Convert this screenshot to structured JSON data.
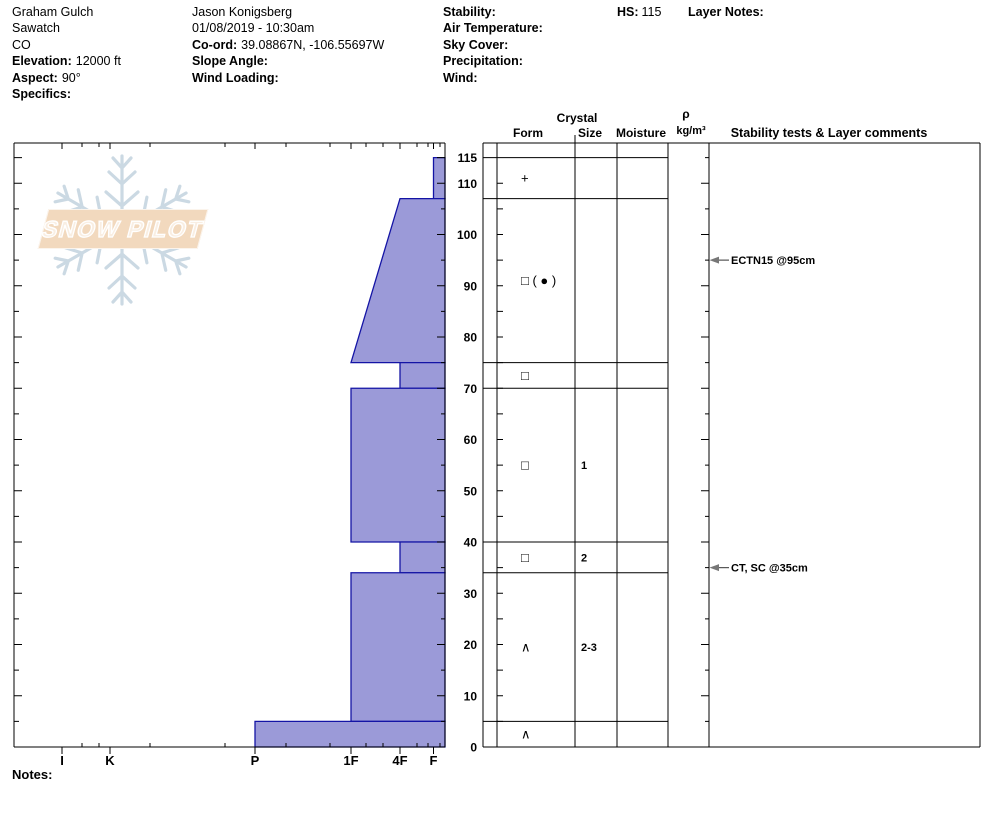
{
  "header": {
    "pit_name": "Graham Gulch",
    "range": "Sawatch",
    "state": "CO",
    "elevation_label": "Elevation:",
    "elevation_value": "12000 ft",
    "aspect_label": "Aspect:",
    "aspect_value": "90°",
    "specifics_label": "Specifics:",
    "observer": "Jason Konigsberg",
    "datetime": "01/08/2019 - 10:30am",
    "coord_label": "Co-ord:",
    "coord_value": "39.08867N, -106.55697W",
    "slope_angle_label": "Slope Angle:",
    "wind_loading_label": "Wind Loading:",
    "stability_label": "Stability:",
    "air_temperature_label": "Air Temperature:",
    "sky_cover_label": "Sky Cover:",
    "precipitation_label": "Precipitation:",
    "wind_label": "Wind:",
    "hs_label": "HS:",
    "hs_value": "115",
    "layer_notes_label": "Layer Notes:"
  },
  "logo": {
    "text": "SNOW PILOT",
    "banner_color": "#f2d9be",
    "snowflake_color": "#c6d5e0"
  },
  "notes_label": "Notes:",
  "table": {
    "crystal_header": "Crystal",
    "form_header": "Form",
    "size_header": "Size",
    "moisture_header": "Moisture",
    "rho_label": "ρ",
    "rho_units": "kg/m³",
    "stability_header": "Stability tests & Layer comments"
  },
  "chart_data": {
    "type": "bar",
    "orientation": "horizontal-snow-profile",
    "title": "Snow pit hardness profile",
    "hs_total_cm": 115,
    "depth_axis": {
      "unit": "cm",
      "max": 118,
      "tick_labels": [
        115,
        110,
        100,
        90,
        80,
        70,
        60,
        50,
        40,
        30,
        20,
        10,
        0
      ],
      "minor_step_cm": 5
    },
    "hardness_axis": {
      "categories": [
        "I",
        "K",
        "P",
        "1F",
        "4F",
        "F"
      ]
    },
    "layers": [
      {
        "top_cm": 115,
        "bottom_cm": 107,
        "hardness_top": "F",
        "hardness_bottom": "F",
        "form_symbol": "+",
        "grain_type": "precipitation-particles",
        "size_mm": "",
        "moisture": ""
      },
      {
        "top_cm": 107,
        "bottom_cm": 75,
        "hardness_top": "4F",
        "hardness_bottom": "1F",
        "form_symbol": "□ ( ● )",
        "grain_type": "facets-rounding",
        "size_mm": "",
        "moisture": ""
      },
      {
        "top_cm": 75,
        "bottom_cm": 70,
        "hardness_top": "4F",
        "hardness_bottom": "4F",
        "form_symbol": "□",
        "grain_type": "facets",
        "size_mm": "",
        "moisture": ""
      },
      {
        "top_cm": 70,
        "bottom_cm": 40,
        "hardness_top": "1F",
        "hardness_bottom": "1F",
        "form_symbol": "□",
        "grain_type": "facets",
        "size_mm": "1",
        "moisture": ""
      },
      {
        "top_cm": 40,
        "bottom_cm": 34,
        "hardness_top": "4F",
        "hardness_bottom": "4F",
        "form_symbol": "□",
        "grain_type": "facets",
        "size_mm": "2",
        "moisture": ""
      },
      {
        "top_cm": 34,
        "bottom_cm": 5,
        "hardness_top": "1F",
        "hardness_bottom": "1F",
        "form_symbol": "∧",
        "grain_type": "depth-hoar",
        "size_mm": "2-3",
        "moisture": ""
      },
      {
        "top_cm": 5,
        "bottom_cm": 0,
        "hardness_top": "P",
        "hardness_bottom": "P",
        "form_symbol": "∧",
        "grain_type": "depth-hoar",
        "size_mm": "",
        "moisture": ""
      }
    ],
    "stability_tests": [
      {
        "label": "ECTN15 @95cm",
        "depth_cm": 95
      },
      {
        "label": "CT, SC @35cm",
        "depth_cm": 35
      }
    ],
    "colors": {
      "bar_fill": "#9b9ad8",
      "bar_stroke": "#1414a5",
      "grid": "#000000",
      "arrow": "#777777"
    },
    "legend_position": "none",
    "grid": "off"
  }
}
